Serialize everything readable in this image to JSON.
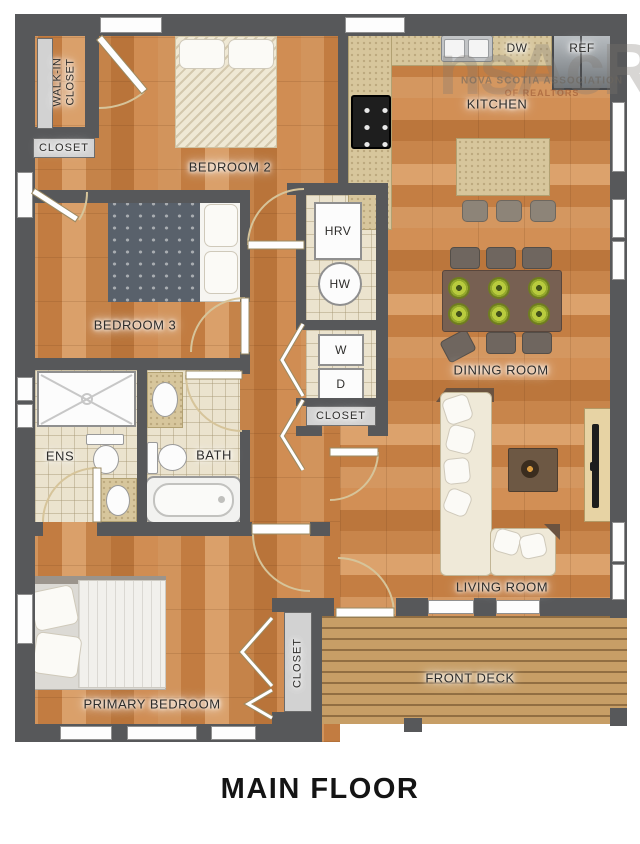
{
  "title": "MAIN FLOOR",
  "watermark": {
    "logo": "nsAcR",
    "line1": "NOVA SCOTIA ASSOCIATION",
    "line2": "OF REALTORS"
  },
  "rooms": {
    "walk_in_closet": "WALK-IN\nCLOSET",
    "closet_top": "CLOSET",
    "bedroom2": "BEDROOM 2",
    "bedroom3": "BEDROOM 3",
    "kitchen": "KITCHEN",
    "dining_room": "DINING ROOM",
    "ens": "ENS",
    "bath": "BATH",
    "living_room": "LIVING ROOM",
    "primary_bedroom": "PRIMARY BEDROOM",
    "closet_hall": "CLOSET",
    "closet_primary": "CLOSET",
    "front_deck": "FRONT DECK"
  },
  "appliances": {
    "dishwasher": "DW",
    "refrigerator": "REF",
    "hrv": "HRV",
    "hot_water": "HW",
    "washer": "W",
    "dryer": "D"
  },
  "colors": {
    "wall": "#57585a",
    "wood": "#cd8c52",
    "tile": "#ebe3ce",
    "counter": "#d7c69c",
    "deck": "#c79e66",
    "plate_green": "#b8cb3e"
  }
}
